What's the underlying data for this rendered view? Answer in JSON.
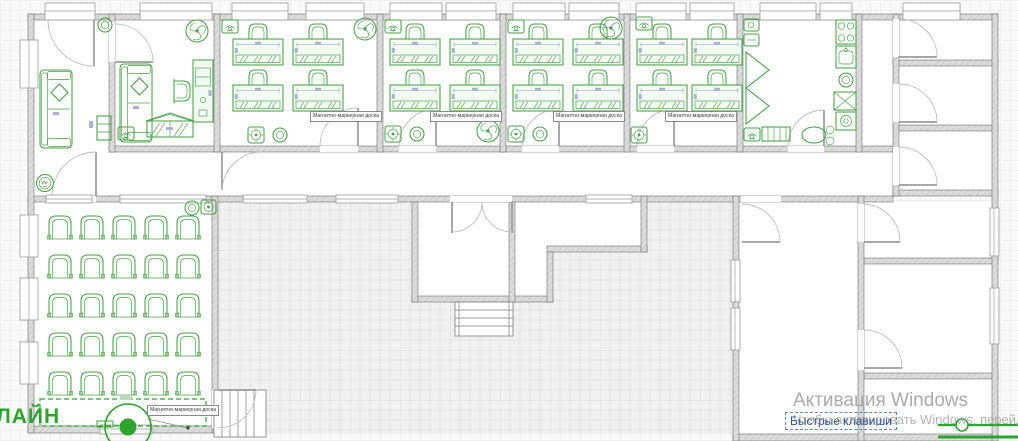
{
  "watermark": {
    "line1": "Активация Windows",
    "line2": "Чтобы активировать Windows, перейдите в раздел"
  },
  "footer": {
    "shortcuts_label": "Быстрые клавиши"
  },
  "plan": {
    "corner_label": "ЛАЙН",
    "board_label": "Магнитно-маркерная доска",
    "colors": {
      "furniture_green": "#46a046",
      "marker_green": "#2ba42b",
      "wall_gray": "#dcdcdc",
      "link_blue": "#30568f",
      "watermark_gray": "#9c9c9c",
      "grid_bg": "#fafafa"
    }
  }
}
